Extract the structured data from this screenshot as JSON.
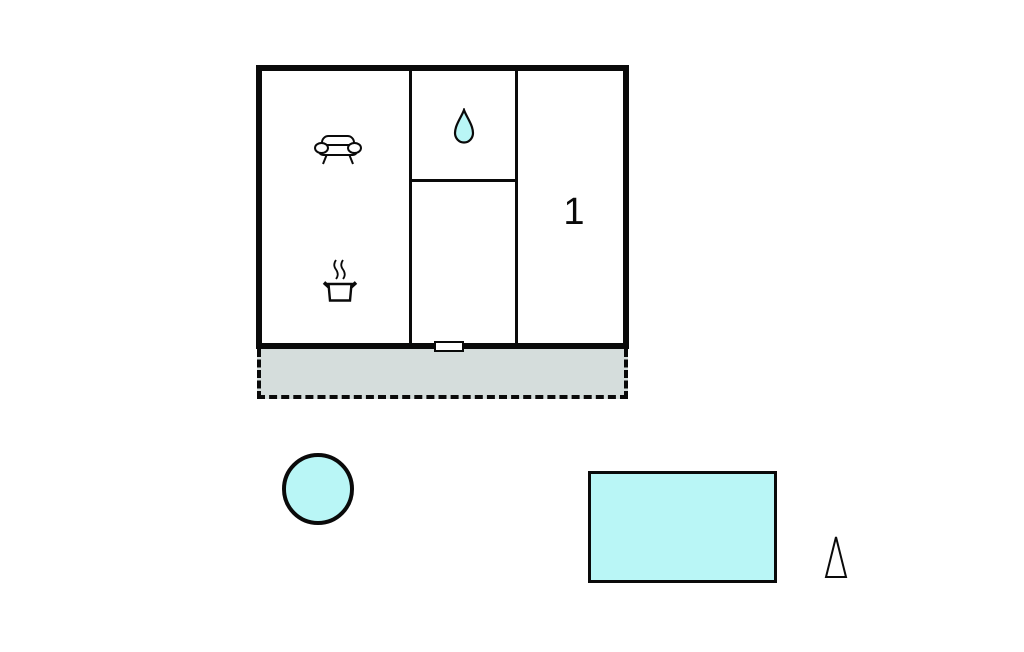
{
  "colors": {
    "background": "#ffffff",
    "wall": "#0a0a0a",
    "water": "#b9f6f6",
    "terrace_fill": "#d5dddc",
    "room_fill": "#ffffff"
  },
  "building": {
    "bedroom_label": "1",
    "icons": [
      {
        "name": "sofa-icon"
      },
      {
        "name": "cooking-pot-icon"
      },
      {
        "name": "water-drop-icon"
      }
    ]
  },
  "outdoor": {
    "icons": [
      {
        "name": "north-arrow-icon"
      }
    ]
  }
}
